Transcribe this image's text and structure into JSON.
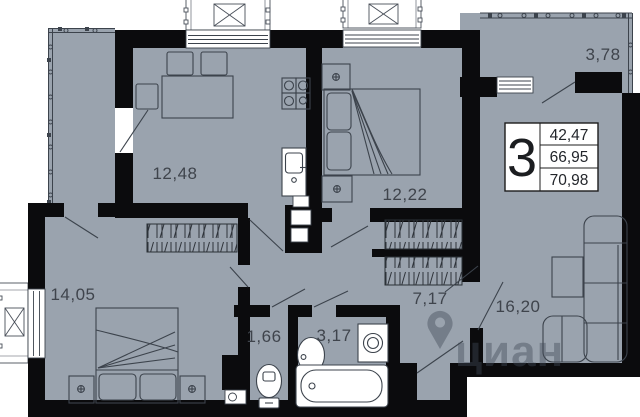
{
  "plan": {
    "rooms": {
      "kitchen_living": "12,48",
      "bedroom_top": "12,22",
      "balcony_right": "3,78",
      "living_right": "16,20",
      "bedroom_left": "14,05",
      "hallway": "7,17",
      "wc": "1,66",
      "bathroom": "3,17"
    },
    "badge": {
      "room_count": "3",
      "areas": [
        "42,47",
        "66,95",
        "70,98"
      ]
    },
    "watermark": {
      "text": "циан"
    },
    "colors": {
      "floor": "#9aa3ae",
      "wall": "#0b0b0d",
      "furniture_line": "#3c434c",
      "label": "#3f444c",
      "watermark": "#414a57"
    }
  }
}
